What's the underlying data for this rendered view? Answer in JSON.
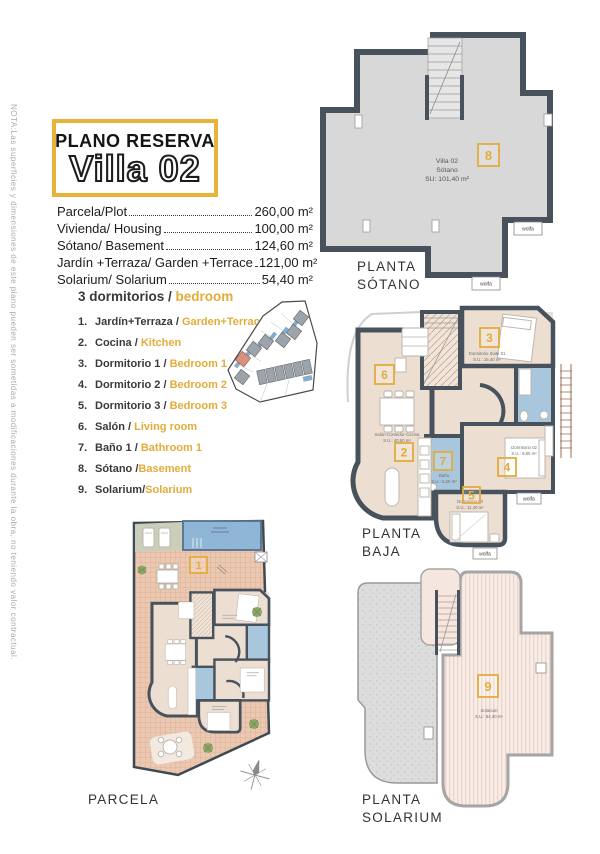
{
  "note": "NOTA:Las superficies y dimensiones de este plano pueden ser sometidas a modificaciones durante la obra, no teniendo valor contractual.",
  "header": {
    "kicker": "PLANO RESERVA",
    "title": "Villa 02"
  },
  "surfaces": [
    {
      "label": "Parcela/Plot",
      "value": "260,00 m²"
    },
    {
      "label": "Vivienda/ Housing",
      "value": "100,00 m²"
    },
    {
      "label": "Sótano/ Basement",
      "value": "124,60 m²"
    },
    {
      "label": "Jardín +Terraza/ Garden +Terrace",
      "value": "121,00 m²"
    },
    {
      "label": "Solarium/ Solarium",
      "value": "54,40 m²"
    }
  ],
  "legend": {
    "heading_es": "3 dormitorios",
    "heading_sep": " / ",
    "heading_en": "bedroom",
    "items": [
      {
        "num": "1.",
        "es": "Jardín+Terraza",
        "sep": " / ",
        "en": "Garden+Terrace"
      },
      {
        "num": "2.",
        "es": "Cocina",
        "sep": " / ",
        "en": "Kitchen"
      },
      {
        "num": "3.",
        "es": "Dormitorio 1",
        "sep": " / ",
        "en": "Bedroom 1"
      },
      {
        "num": "4.",
        "es": "Dormitorio 2",
        "sep": " / ",
        "en": "Bedroom 2"
      },
      {
        "num": "5.",
        "es": "Dormitorio 3",
        "sep": " / ",
        "en": "Bedroom 3"
      },
      {
        "num": "6.",
        "es": "Salón",
        "sep": " / ",
        "en": "Living room"
      },
      {
        "num": "7.",
        "es": "Baño 1",
        "sep": " / ",
        "en": "Bathroom 1"
      },
      {
        "num": "8.",
        "es": "Sótano",
        "sep": " /",
        "en": "Basement"
      },
      {
        "num": "9.",
        "es": "Solarium",
        "sep": "/",
        "en": "Solarium"
      }
    ]
  },
  "plans": {
    "sotano": {
      "caption": [
        "PLANTA",
        "SÓTANO"
      ],
      "number": "8",
      "title": "Villa 02",
      "subtitle": "Sótano",
      "area": "SU: 101,40 m²",
      "unit_label": "wolfa"
    },
    "baja": {
      "caption": [
        "PLANTA",
        "BAJA"
      ],
      "numbers": {
        "n2": "2",
        "n3": "3",
        "n4": "4",
        "n5": "5",
        "n6": "6",
        "n7": "7"
      },
      "rooms": {
        "salon": {
          "name": "Salón-Comedor-Cocina",
          "area": "S.U.: 40,60 m²"
        },
        "suite": {
          "name": "Dormitorio Suite 01",
          "area": "S.U.: 15,40 m²"
        },
        "distribuidor": {
          "name": "Distribuidor",
          "area": "S.U.: 3,30 m²"
        },
        "bano": {
          "name": "Baño",
          "area": "S.U.: 5,20 m²"
        },
        "dorm2": {
          "name": "Dormitorio 02",
          "area": "S.U.: 9,80 m²"
        },
        "dorm3": {
          "name": "Dormitorio 03",
          "area": "S.U.: 11,40 m²"
        }
      },
      "unit_label": "wolfa"
    },
    "solarium": {
      "caption": [
        "PLANTA",
        "SOLARIUM"
      ],
      "number": "9",
      "name": "Solarium",
      "area": "S.U.: 54,40 m²"
    },
    "parcela": {
      "caption": "PARCELA",
      "number": "1"
    }
  },
  "colors": {
    "accent_yellow": "#E3AC3A",
    "wall_dark": "#47525D",
    "bath_blue": "#A9C7DC",
    "floor_beige": "#EDDED2",
    "basement_gray": "#D8D8D8",
    "tile_terracotta": "#EBC8B2",
    "pool_blue": "#8FB6D6",
    "solarium_pink": "#F9EDE8",
    "site_highlight": "#D9907F"
  }
}
